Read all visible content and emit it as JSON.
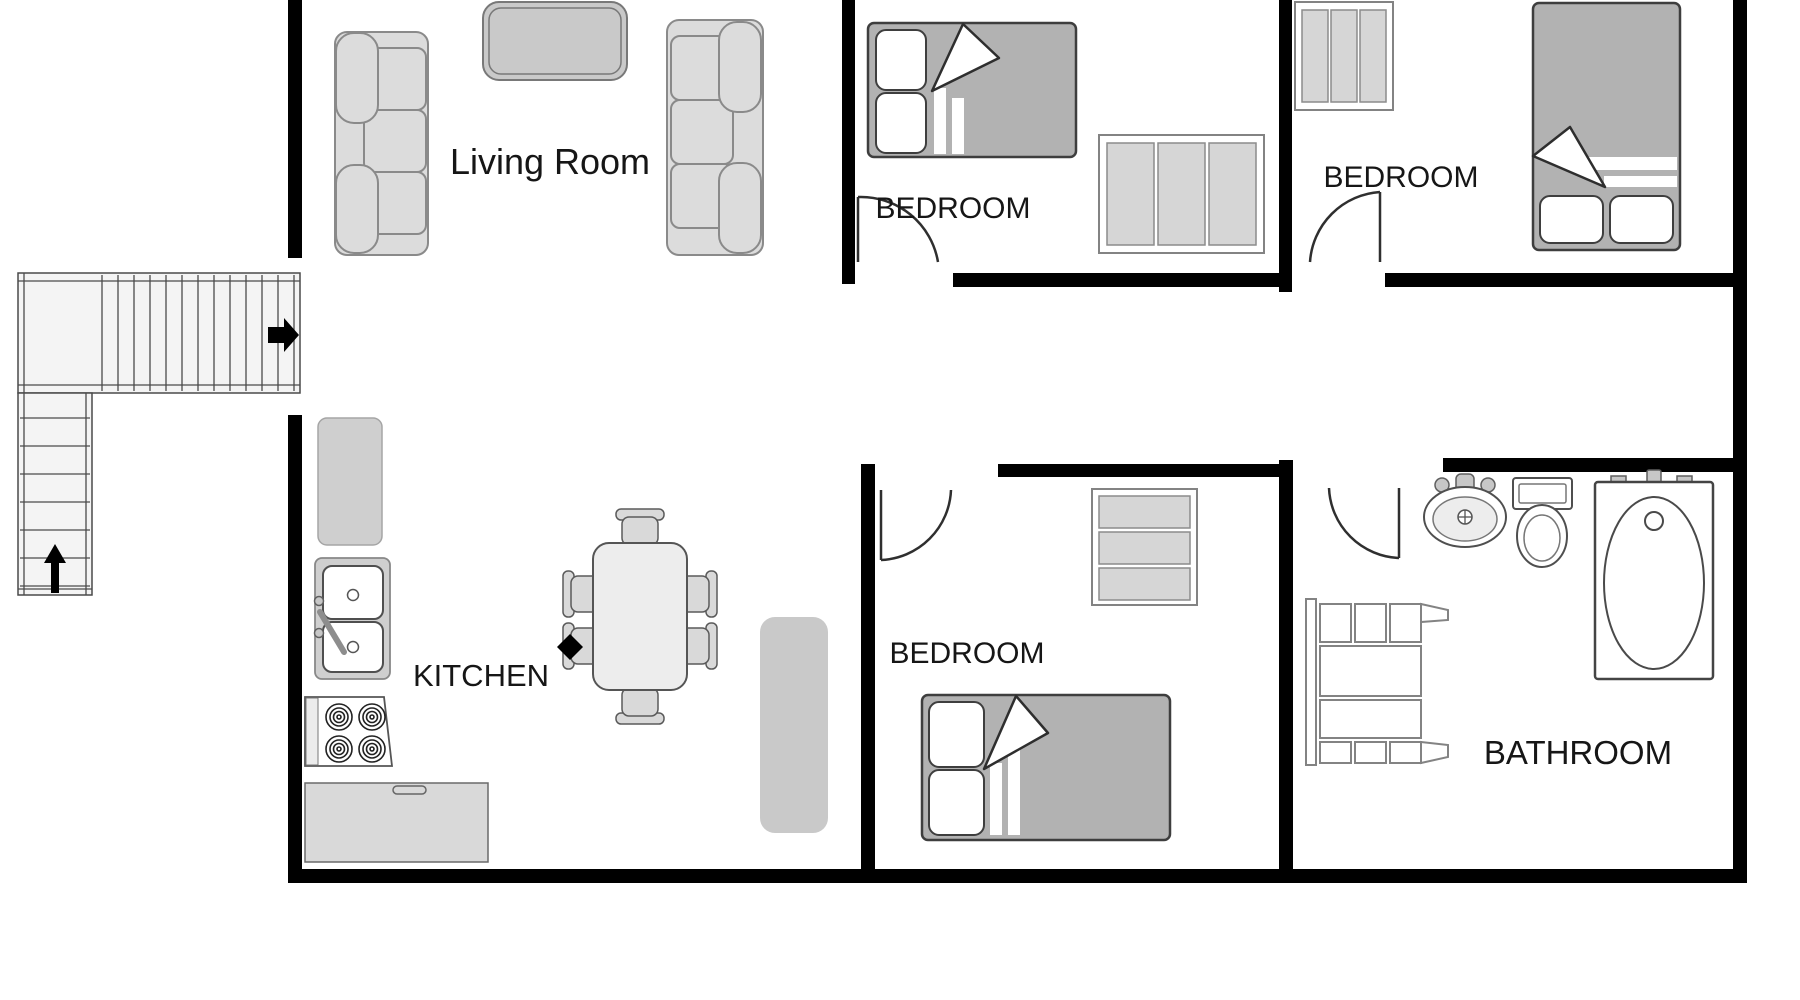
{
  "rooms": {
    "living_room": {
      "label": "Living Room",
      "furniture": [
        "sofa",
        "sofa",
        "coffee-table"
      ]
    },
    "bedroom_top": {
      "label": "BEDROOM",
      "furniture": [
        "double-bed",
        "wardrobe"
      ]
    },
    "bedroom_right": {
      "label": "BEDROOM",
      "furniture": [
        "double-bed",
        "wardrobe"
      ]
    },
    "bedroom_bottom": {
      "label": "BEDROOM",
      "furniture": [
        "double-bed",
        "dresser"
      ]
    },
    "kitchen": {
      "label": "KITCHEN",
      "furniture": [
        "refrigerator",
        "double-sink",
        "stove",
        "counter",
        "dining-table",
        "six-chairs",
        "rug"
      ]
    },
    "bathroom": {
      "label": "BATHROOM",
      "furniture": [
        "sink",
        "toilet",
        "bathtub",
        "shelving-unit"
      ]
    }
  },
  "stairs": {
    "shape": "L-shaped",
    "entry_arrow_icon": "right-arrow-icon",
    "up_arrow_icon": "up-arrow-icon"
  },
  "colors": {
    "wall": "#000000",
    "background": "#ffffff",
    "furniture_light": "#dcdcdc",
    "furniture_mid": "#c9c9c9",
    "bed_blanket": "#b2b2b2",
    "outline_dark": "#3e3e3e",
    "label_text": "#161616"
  }
}
